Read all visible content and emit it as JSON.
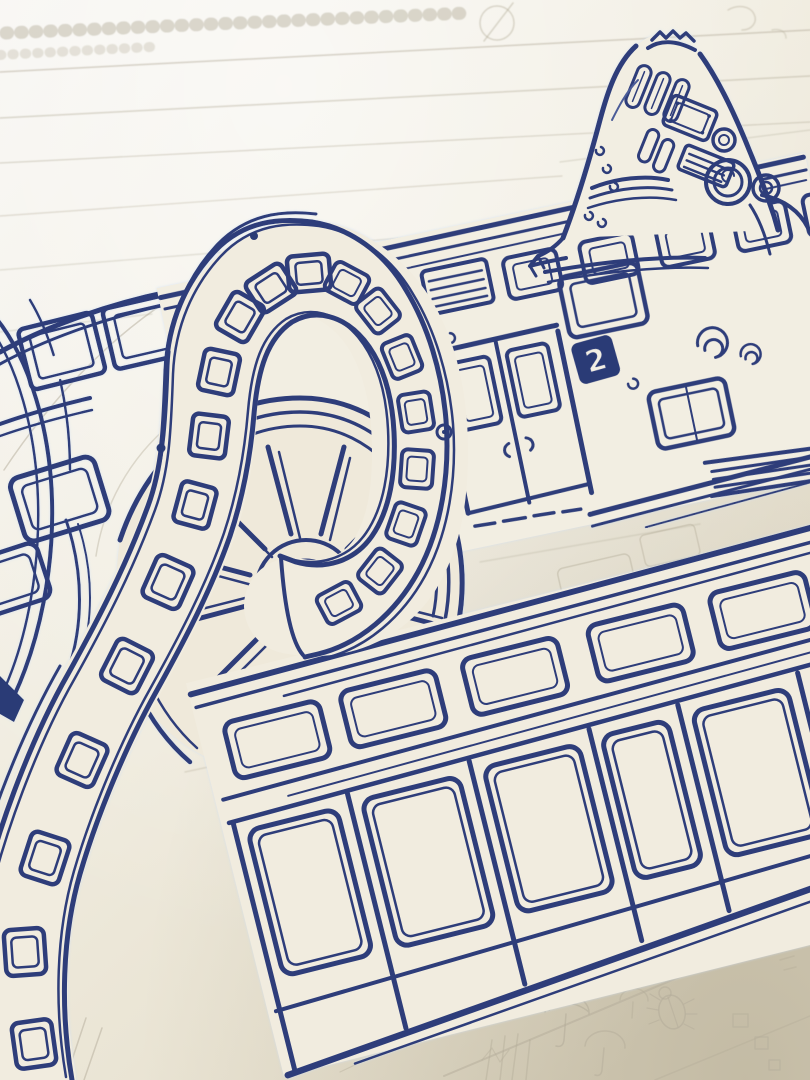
{
  "title": "Close-up photo of an unfinished blue-ink drawing: a tram with a giant spoked flywheel, an ornate riveted stack, and a looping window-lined track, over pencil underdrawing on cream paper",
  "badge": {
    "route_number": "2"
  },
  "palette": {
    "ink_primary": "#2d3d7a",
    "ink_dark": "#263270",
    "ink_light": "#4c5c98",
    "ink_halo": "#cfe0f5",
    "paper_light": "#f6f4f0",
    "paper_mid": "#f0ecdf",
    "paper_shadow": "#ddd6c2",
    "pencil": "#b3ac99"
  },
  "parts": {
    "tower": "Riveted fin-shaped stack with pipes, plaque, gauge, louvre and dome portholes",
    "flywheel": "Large spoked flywheel behind the looping band",
    "loop_track": "Looping tram band lined with small double-framed windows, curling over the flywheel",
    "upper_tram": "Upper tram side: clerestory windows, louvre vents, double door, route badge and scroll ornament",
    "lower_tram": "Lower tram side: window band above tall door panels",
    "upper_left_tram": "Partly hidden tram fragment at upper left with trapezoid windows",
    "pencil_sketch": "Unfinished pencil layer: ruled guidelines, tick strip, circle mark, umbrellas, scarab beetle, ladder and small squares"
  },
  "counts": {
    "loop_windows": 20,
    "flywheel_spokes": 10,
    "lower_tram_small_windows": 5,
    "lower_tram_door_panels": 6
  }
}
